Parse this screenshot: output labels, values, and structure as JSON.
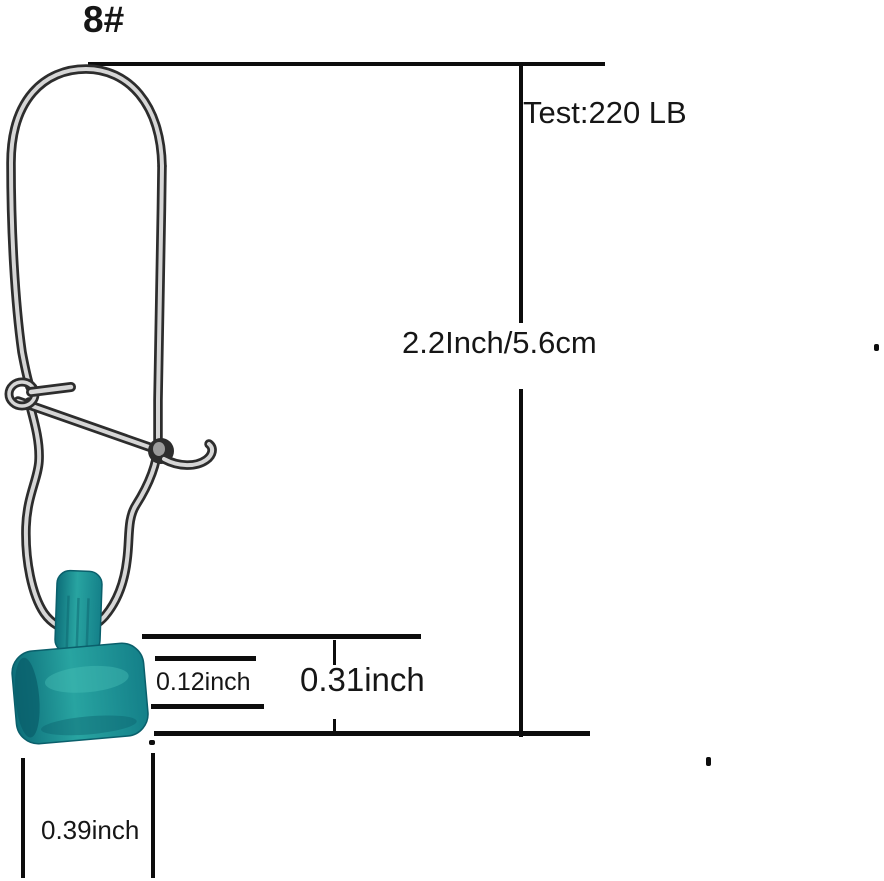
{
  "labels": {
    "size": "8#",
    "test": "Test:220 LB",
    "length": "2.2Inch/5.6cm",
    "clip_gap": "0.12inch",
    "snap_width": "0.31inch",
    "slide_width": "0.39inch"
  },
  "colors": {
    "line": "#0d0d0d",
    "text": "#161616",
    "wire_dark": "#2d2d2d",
    "wire_light": "#d6d6d6",
    "knot_highlight": "#9a9a9a",
    "slide_dark": "#0d6e79",
    "slide_bright": "#28a4a1",
    "slide_mid": "#148089",
    "slide_deep": "#0a5f6b",
    "slide_highlight": "#4cc2b8"
  }
}
